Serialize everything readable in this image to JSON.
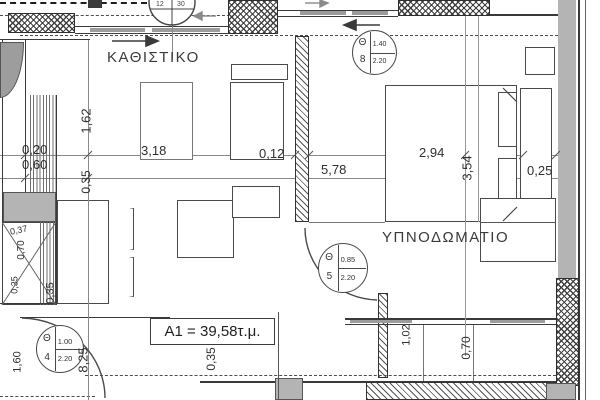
{
  "rooms": {
    "living": "ΚΑΘΙΣΤΙΚΟ",
    "bedroom": "ΥΠΝΟΔΩΜΑΤΙΟ"
  },
  "area": {
    "label": "A1 = 39,58τ.μ."
  },
  "dims": {
    "w_020": "0,20",
    "w_060": "0,60",
    "w_318": "3,18",
    "w_012": "0,12",
    "w_578": "5,78",
    "w_294": "2,94",
    "w_025": "0,25",
    "h_162": "1,62",
    "h_035_a": "0,35",
    "h_354": "3,54",
    "h_825": "8,25",
    "h_035_b": "0,35",
    "h_035_c": "0,35",
    "h_035_d": "0,35",
    "h_102": "1,02",
    "h_070": "0,70",
    "h_037": "0,37",
    "h_070_b": "0,70",
    "h_160": "1,60"
  },
  "markers": {
    "m8": {
      "letter": "Θ",
      "index": "8",
      "width": "1.40",
      "height": "2.20"
    },
    "m5": {
      "letter": "Θ",
      "index": "5",
      "width": "0.85",
      "height": "2.20"
    },
    "m4": {
      "letter": "Θ",
      "index": "4",
      "width": "1.00",
      "height": "2.20"
    }
  },
  "window_marker": {
    "left": "12",
    "right": "30"
  },
  "colors": {
    "wall_gray": "#b4b4b4",
    "line_dark": "#333333",
    "chain_gray": "#8a8a8a"
  }
}
